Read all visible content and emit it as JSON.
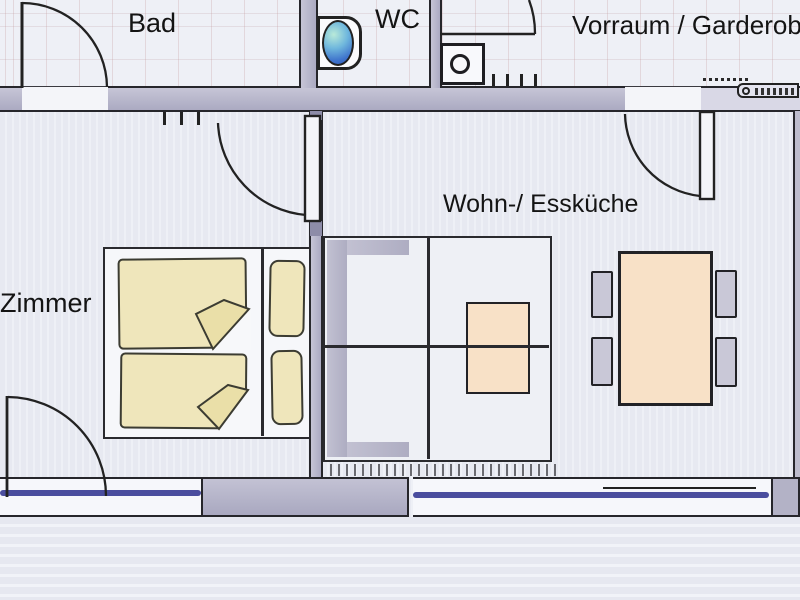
{
  "plan_type": "apartment floor plan (hand-drawn, scanned)",
  "rooms": {
    "bad": {
      "label": "Bad"
    },
    "wc": {
      "label": "WC"
    },
    "vorraum": {
      "label": "Vorraum / Garderobe"
    },
    "zimmer": {
      "label": "Zimmer"
    },
    "wohn_esskueche": {
      "label": "Wohn-/ Essküche"
    }
  },
  "fixtures": [
    {
      "name": "toilet-with-cistern",
      "room": "wc"
    },
    {
      "name": "washing-machine",
      "room": "vorraum"
    },
    {
      "name": "coat-hooks",
      "room": "vorraum"
    },
    {
      "name": "wall-radiator",
      "room": "vorraum"
    },
    {
      "name": "double-bed-with-duvets-and-pillows",
      "room": "zimmer"
    },
    {
      "name": "wall-hooks",
      "room": "zimmer"
    },
    {
      "name": "corner-sofa",
      "room": "wohn_esskueche"
    },
    {
      "name": "coffee-table",
      "room": "wohn_esskueche"
    },
    {
      "name": "dining-table-with-four-chairs",
      "room": "wohn_esskueche"
    },
    {
      "name": "radiator-strip-under-window",
      "room": "wohn_esskueche"
    }
  ],
  "doors": [
    {
      "name": "bad-door",
      "swing": "into Bad"
    },
    {
      "name": "entrance-door",
      "swing": "into Vorraum from top"
    },
    {
      "name": "kitchen-door",
      "swing": "from Vorraum into Wohn-/ Essküche"
    },
    {
      "name": "zimmer-door",
      "swing": "from Wohn-/ Essküche into Zimmer"
    },
    {
      "name": "balcony-door",
      "swing": "into Zimmer, bottom-left"
    }
  ],
  "windows": [
    {
      "name": "window-zimmer",
      "glazing_color": "#3b3e96"
    },
    {
      "name": "window-kueche",
      "glazing_color": "#3b3e96"
    }
  ],
  "colors": {
    "wall": "#b5b4c9",
    "window_glass": "#3b3e96",
    "bedding": "#efe6bb",
    "table_top": "#f8e1c7",
    "sofa_gray": "#b9b8c8",
    "chair_gray": "#c9c8d7",
    "toilet_bowl_blue": "#4a86d8",
    "paper": "#e9ebf2",
    "line": "#222226"
  }
}
